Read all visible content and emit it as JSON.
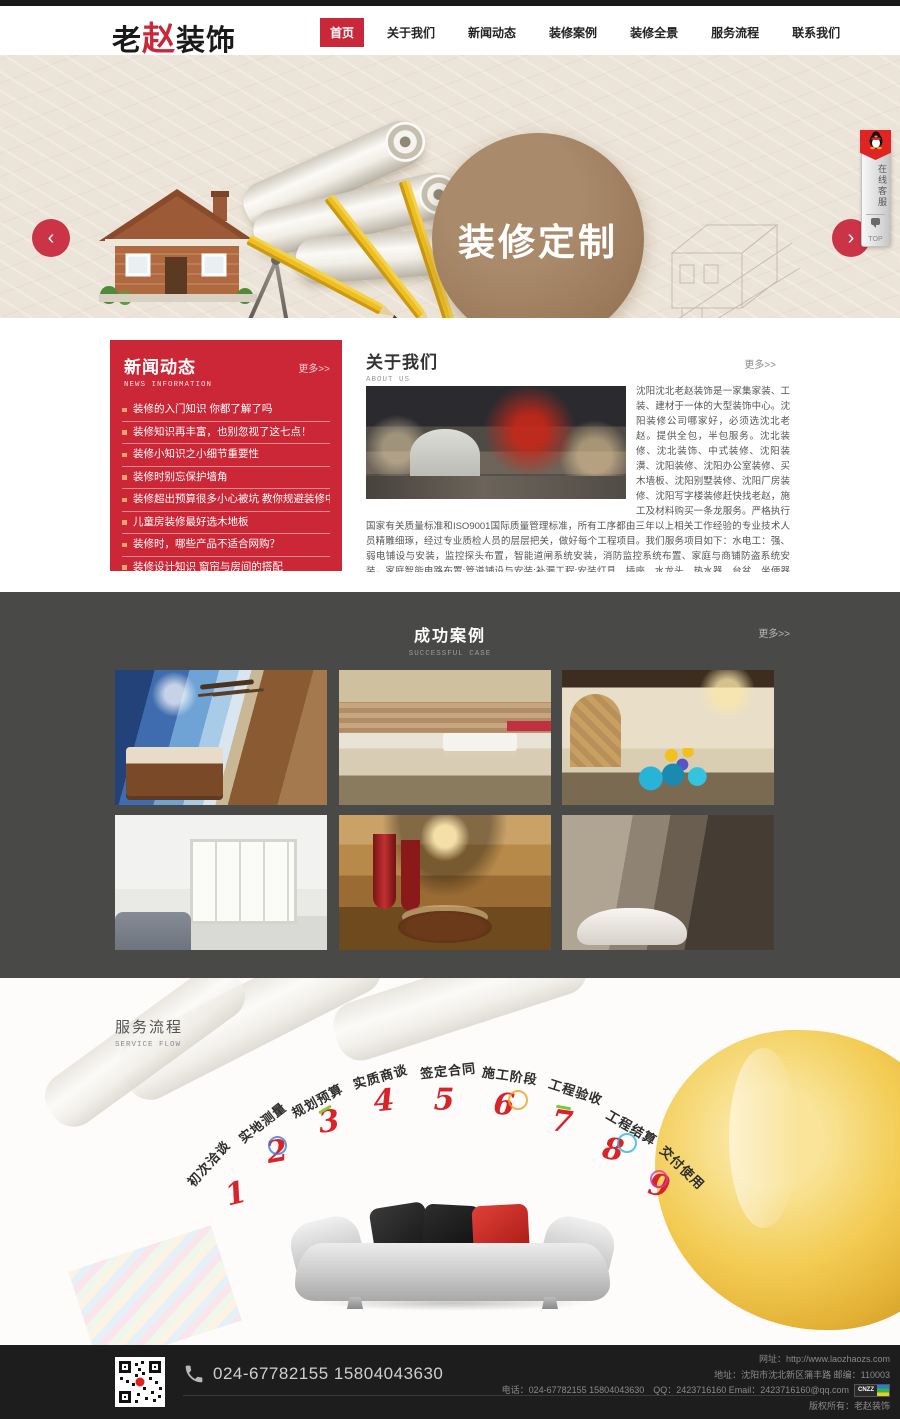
{
  "header": {
    "logo_part1": "老",
    "logo_part2": "赵",
    "logo_part3": "装饰",
    "nav": [
      {
        "label": "首页"
      },
      {
        "label": "关于我们"
      },
      {
        "label": "新闻动态"
      },
      {
        "label": "装修案例"
      },
      {
        "label": "装修全景"
      },
      {
        "label": "服务流程"
      },
      {
        "label": "联系我们"
      }
    ]
  },
  "banner": {
    "circle_text": "装修定制",
    "prev_arrow": "‹",
    "next_arrow": "›",
    "qq_service_text": "在线客服",
    "qq_top_text": "TOP",
    "colors": {
      "background": "#ece4d8",
      "circle": "#9b7a5b",
      "arrow": "#cb3346"
    }
  },
  "news": {
    "title": "新闻动态",
    "subtitle": "NEWS INFORMATION",
    "more": "更多>>",
    "items": [
      "装修的入门知识 你都了解了吗",
      "装修知识再丰富，也别忽视了这七点！",
      "装修小知识之小细节重要性",
      "装修时别忘保护墙角",
      "装修超出预算很多小心被坑 教你规避装修中的问题",
      "儿童房装修最好选木地板",
      "装修时，哪些产品不适合网购？",
      "装修设计知识 窗帘与房间的搭配"
    ],
    "panel_color": "#cb2737"
  },
  "about": {
    "title": "关于我们",
    "subtitle": "ABOUT US",
    "more": "更多>>",
    "text": "沈阳沈北老赵装饰是一家集家装、工装、建材于一体的大型装饰中心。沈阳装修公司哪家好，必须选沈北老赵。提供全包，半包服务。沈北装修、沈北装饰、中式装修、沈阳装潢、沈阳装修、沈阳办公室装修、买木墙板、沈阳别墅装修、沈阳厂房装修、沈阳写字楼装修赶快找老赵，施工及材料购买一条龙服务。严格执行国家有关质量标准和ISO9001国际质量管理标准，所有工序都由三年以上相关工作经验的专业技术人员精雕细琢，经过专业质检人员的层层把关，做好每个工程项目。我们服务项目如下：水电工：强、弱电铺设与安装，监控探头布置，智能道闸系统安装，消防监控系统布置、家庭与商铺防盗系统安装，家庭智能电路布置:管道铺设与安装:补漏工程:安装灯具、插座、水龙头、热水器、台盆、坐便器等。泥工；墙面挂灰、碎拼地面与墙面花色、砌墙、铺地砖，墙砖、大理石、厨卫做防水处理、地面找平等木工：衣柜、装饰柜、移门、门窗内外套，制作各…"
  },
  "cases": {
    "title": "成功案例",
    "subtitle": "SUCCESSFUL CASE",
    "more": "更多>>",
    "section_color": "#494947"
  },
  "service": {
    "title": "服务流程",
    "subtitle": "SERVICE FLOW",
    "steps": [
      {
        "num": "1",
        "label": "初次洽谈"
      },
      {
        "num": "2",
        "label": "实地测量"
      },
      {
        "num": "3",
        "label": "规划预算"
      },
      {
        "num": "4",
        "label": "实质商谈"
      },
      {
        "num": "5",
        "label": "签定合同"
      },
      {
        "num": "6",
        "label": "施工阶段"
      },
      {
        "num": "7",
        "label": "工程验收"
      },
      {
        "num": "8",
        "label": "工程结算"
      },
      {
        "num": "9",
        "label": "交付使用"
      }
    ]
  },
  "footer": {
    "phone_large": "024-67782155 15804043630",
    "website_line": "网址：http://www.laozhaozs.com",
    "address_line": "地址：沈阳市沈北新区蒲丰路 邮编：110003",
    "contact_line": "电话：024-67782155 15804043630　QQ：2423716160 Email：2423716160@qq.com",
    "copyright_line": "版权所有：老赵装饰",
    "cnzz_label": "CNZZ"
  }
}
